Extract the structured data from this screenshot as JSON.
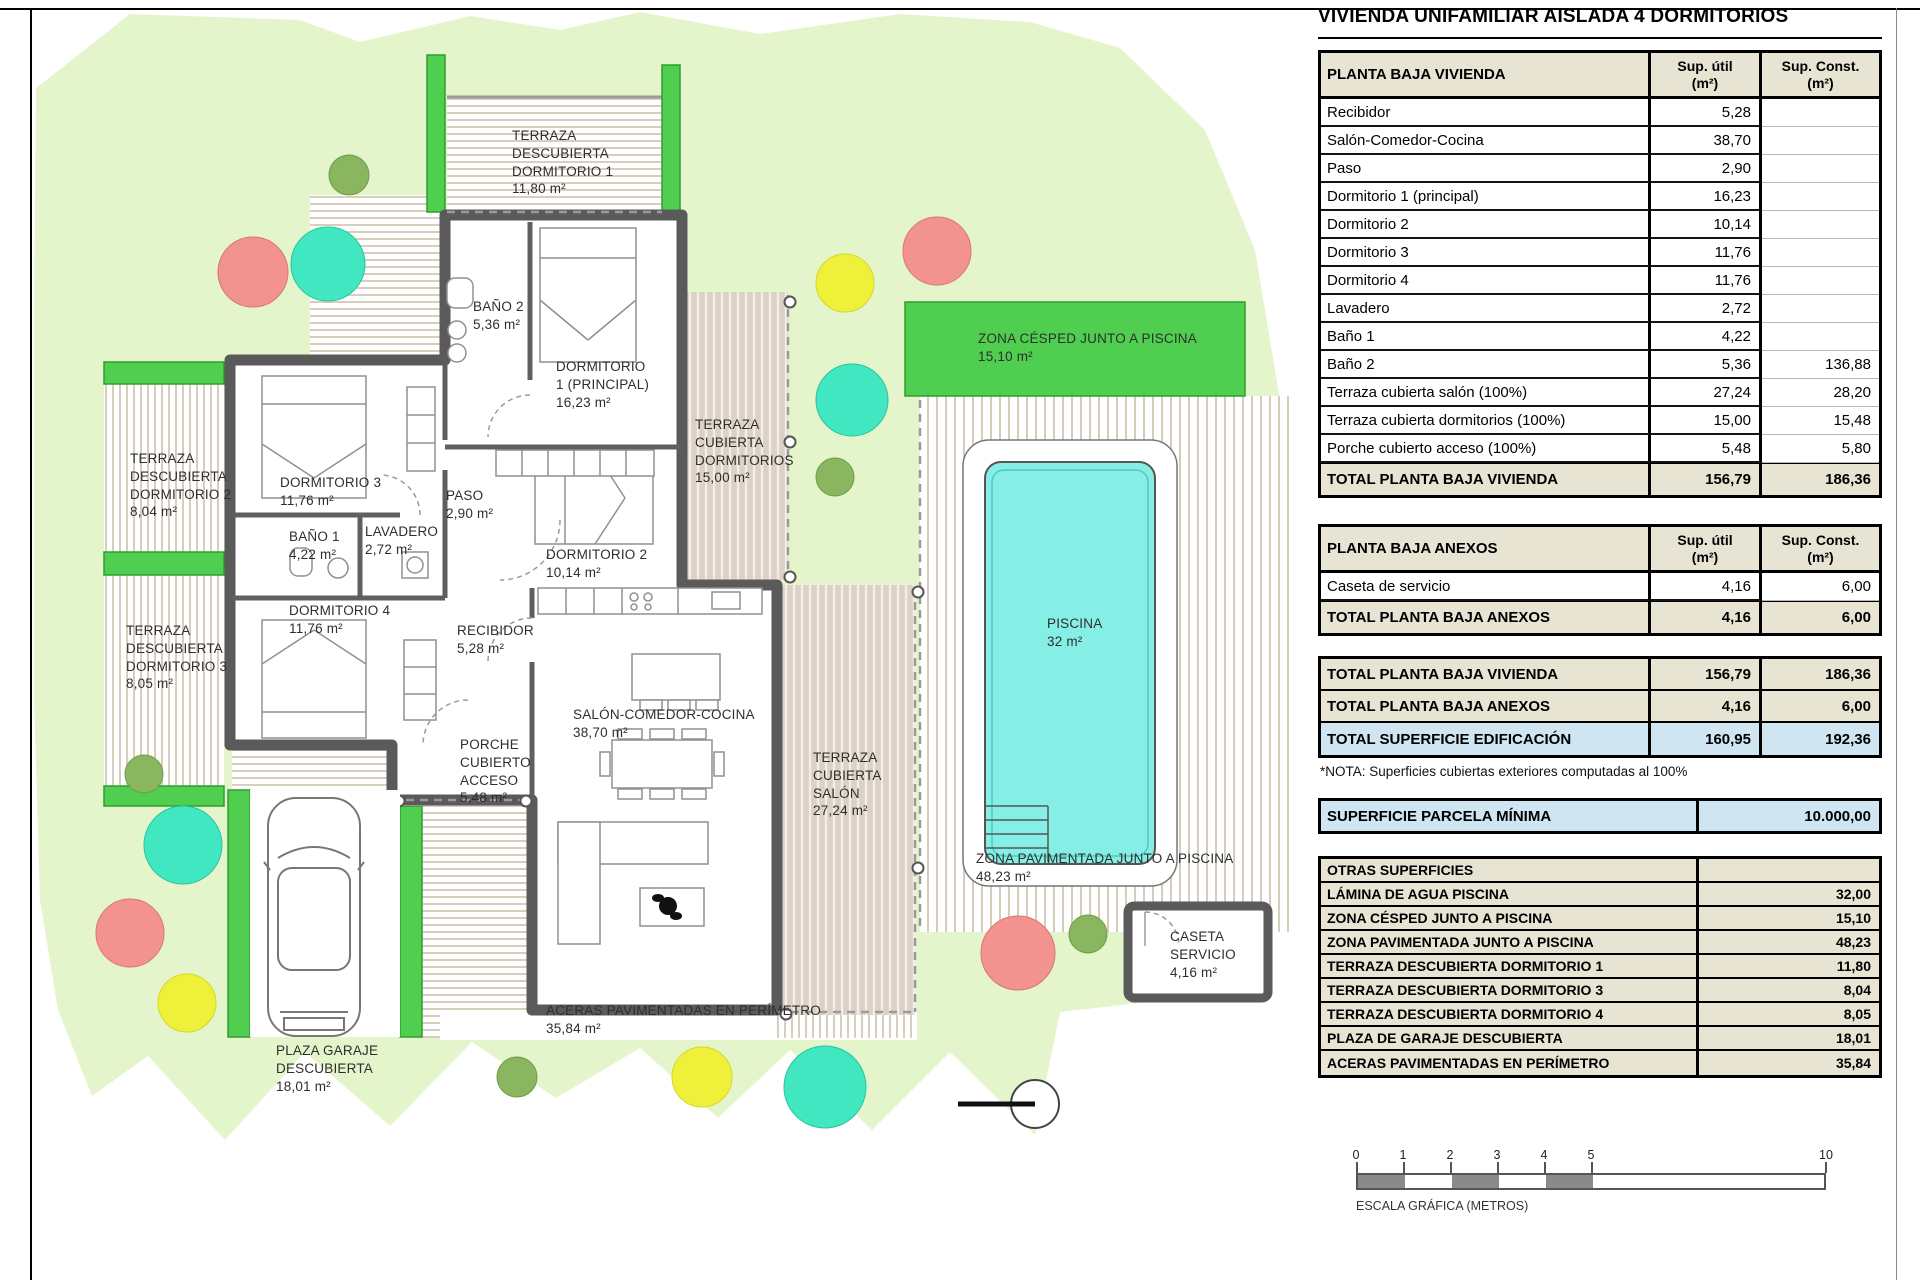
{
  "title": "VIVIENDA UNIFAMILIAR AISLADA 4 DORMITORIOS",
  "tables": {
    "t1": {
      "title": "PLANTA BAJA VIVIENDA",
      "col1": "Sup. útil\n(m²)",
      "col2": "Sup. Const.\n(m²)",
      "rows": [
        [
          "Recibidor",
          "5,28",
          ""
        ],
        [
          "Salón-Comedor-Cocina",
          "38,70",
          ""
        ],
        [
          "Paso",
          "2,90",
          ""
        ],
        [
          "Dormitorio 1 (principal)",
          "16,23",
          ""
        ],
        [
          "Dormitorio 2",
          "10,14",
          ""
        ],
        [
          "Dormitorio 3",
          "11,76",
          ""
        ],
        [
          "Dormitorio 4",
          "11,76",
          ""
        ],
        [
          "Lavadero",
          "2,72",
          ""
        ],
        [
          "Baño 1",
          "4,22",
          ""
        ],
        [
          "Baño 2",
          "5,36",
          "136,88"
        ],
        [
          "Terraza cubierta salón (100%)",
          "27,24",
          "28,20"
        ],
        [
          "Terraza cubierta dormitorios (100%)",
          "15,00",
          "15,48"
        ],
        [
          "Porche cubierto acceso (100%)",
          "5,48",
          "5,80"
        ]
      ],
      "total": [
        "TOTAL PLANTA BAJA VIVIENDA",
        "156,79",
        "186,36"
      ]
    },
    "t2": {
      "title": "PLANTA BAJA ANEXOS",
      "col1": "Sup. útil\n(m²)",
      "col2": "Sup. Const.\n(m²)",
      "rows": [
        [
          "Caseta de servicio",
          "4,16",
          "6,00"
        ]
      ],
      "total": [
        "TOTAL PLANTA BAJA ANEXOS",
        "4,16",
        "6,00"
      ]
    },
    "t3": {
      "rows": [
        [
          "TOTAL PLANTA BAJA VIVIENDA",
          "156,79",
          "186,36"
        ],
        [
          "TOTAL PLANTA BAJA ANEXOS",
          "4,16",
          "6,00"
        ],
        [
          "TOTAL SUPERFICIE EDIFICACIÓN",
          "160,95",
          "192,36"
        ]
      ]
    },
    "nota": "*NOTA: Superficies cubiertas exteriores computadas al 100%",
    "parcela": [
      "SUPERFICIE PARCELA MÍNIMA",
      "10.000,00"
    ],
    "otras": {
      "title": "OTRAS SUPERFICIES",
      "rows": [
        [
          "LÁMINA DE AGUA PISCINA",
          "32,00"
        ],
        [
          "ZONA CÉSPED JUNTO A PISCINA",
          "15,10"
        ],
        [
          "ZONA PAVIMENTADA JUNTO A PISCINA",
          "48,23"
        ],
        [
          "TERRAZA DESCUBIERTA DORMITORIO 1",
          "11,80"
        ],
        [
          "TERRAZA DESCUBIERTA DORMITORIO 3",
          "8,04"
        ],
        [
          "TERRAZA DESCUBIERTA DORMITORIO 4",
          "8,05"
        ],
        [
          "PLAZA DE GARAJE DESCUBIERTA",
          "18,01"
        ],
        [
          "ACERAS PAVIMENTADAS EN PERÍMETRO",
          "35,84"
        ]
      ]
    }
  },
  "plan": {
    "labels": {
      "terraza_dorm1": "TERRAZA\nDESCUBIERTA\nDORMITORIO 1\n11,80 m²",
      "terraza_dorm2": "TERRAZA\nDESCUBIERTA\nDORMITORIO 2\n8,04 m²",
      "terraza_dorm3": "TERRAZA\nDESCUBIERTA\nDORMITORIO 3\n8,05 m²",
      "bano2": "BAÑO 2\n5,36 m²",
      "dorm1": "DORMITORIO\n1 (PRINCIPAL)\n16,23 m²",
      "terraza_cub_dorms": "TERRAZA\nCUBIERTA\nDORMITORIOS\n15,00 m²",
      "dorm3": "DORMITORIO 3\n11,76 m²",
      "paso": "PASO\n2,90 m²",
      "bano1": "BAÑO 1\n4,22 m²",
      "lavadero": "LAVADERO\n2,72 m²",
      "dorm4": "DORMITORIO 4\n11,76 m²",
      "dorm2": "DORMITORIO 2\n10,14 m²",
      "recibidor": "RECIBIDOR\n5,28 m²",
      "salon": "SALÓN-COMEDOR-COCINA\n38,70 m²",
      "porche": "PORCHE\nCUBIERTO\nACCESO\n5,48 m²",
      "terraza_cub_salon": "TERRAZA\nCUBIERTA\nSALÓN\n27,24 m²",
      "cesped": "ZONA CÉSPED JUNTO A PISCINA\n15,10 m²",
      "piscina": "PISCINA\n32 m²",
      "zona_pav": "ZONA PAVIMENTADA JUNTO A PISCINA\n48,23 m²",
      "caseta": "CASETA\nSERVICIO\n4,16 m²",
      "garaje": "PLAZA GARAJE\nDESCUBIERTA\n18,01 m²",
      "aceras": "ACERAS PAVIMENTADAS EN PERÍMETRO\n35,84 m²"
    }
  },
  "scalebar": {
    "ticks": [
      "0",
      "1",
      "2",
      "3",
      "4",
      "5",
      "10"
    ],
    "label": "ESCALA GRÁFICA (METROS)"
  },
  "colors": {
    "garden": "#e4f5cb",
    "bright_green": "#4fce4f",
    "pool_water": "#85efe6",
    "tree_salmon": "#f29390",
    "tree_teal": "#41e7c0",
    "tree_yellow": "#eff03a",
    "tree_olive": "#8bb660",
    "wall": "#5a5a5a",
    "table_header_beige": "#e8e4d4",
    "highlight_blue": "#cfe5f1"
  }
}
